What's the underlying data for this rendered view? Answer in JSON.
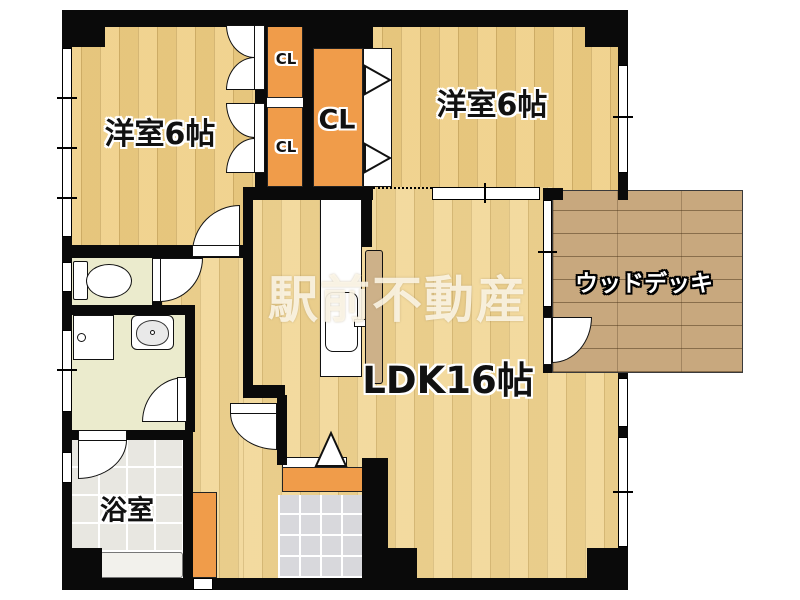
{
  "floorplan": {
    "watermark_text": "駅前不動産",
    "labels": {
      "bedroom_tl": "洋室6帖",
      "bedroom_tr": "洋室6帖",
      "closet_small_top": "CL",
      "closet_small_bottom": "CL",
      "closet_large": "CL",
      "ldk": "LDK16帖",
      "wood_deck": "ウッドデッキ",
      "bathroom": "浴室"
    },
    "colors": {
      "wall_black": "#0a0a0a",
      "bedroom_floor": "#efce84",
      "ldk_floor": "#f1d592",
      "closet_orange": "#f09c4a",
      "deck_wood": "#c8a87e",
      "wet_room_floor": "#ebebcd",
      "bath_tile": "#e8e7e1",
      "genkan_tile": "#d8d8dc",
      "counter_tan": "#cdb189"
    }
  }
}
